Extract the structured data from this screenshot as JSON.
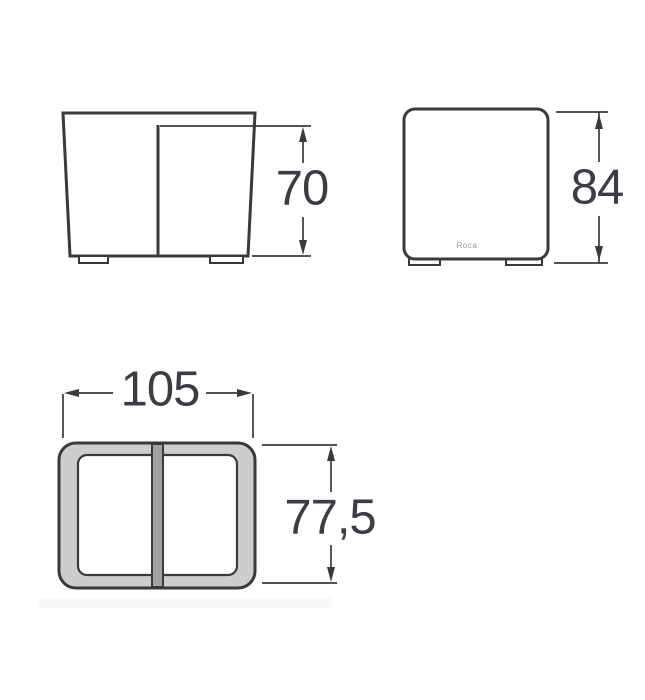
{
  "drawing": {
    "type": "technical-dimension-drawing",
    "brand_logo": "Roca",
    "colors": {
      "line": "#3a3a3a",
      "dimension_text": "#3a3e44",
      "rim_fill": "#cdcdcd",
      "divider_fill": "#a2a2a2",
      "logo_text": "#8f969e",
      "background": "#ffffff"
    },
    "views": {
      "front": {
        "label": "front-elevation",
        "dimension_height": {
          "value": "70"
        }
      },
      "side": {
        "label": "side-elevation",
        "dimension_height": {
          "value": "84"
        }
      },
      "plan": {
        "label": "plan-view",
        "dimension_width": {
          "value": "105"
        },
        "dimension_depth": {
          "value": "77,5"
        }
      }
    }
  }
}
